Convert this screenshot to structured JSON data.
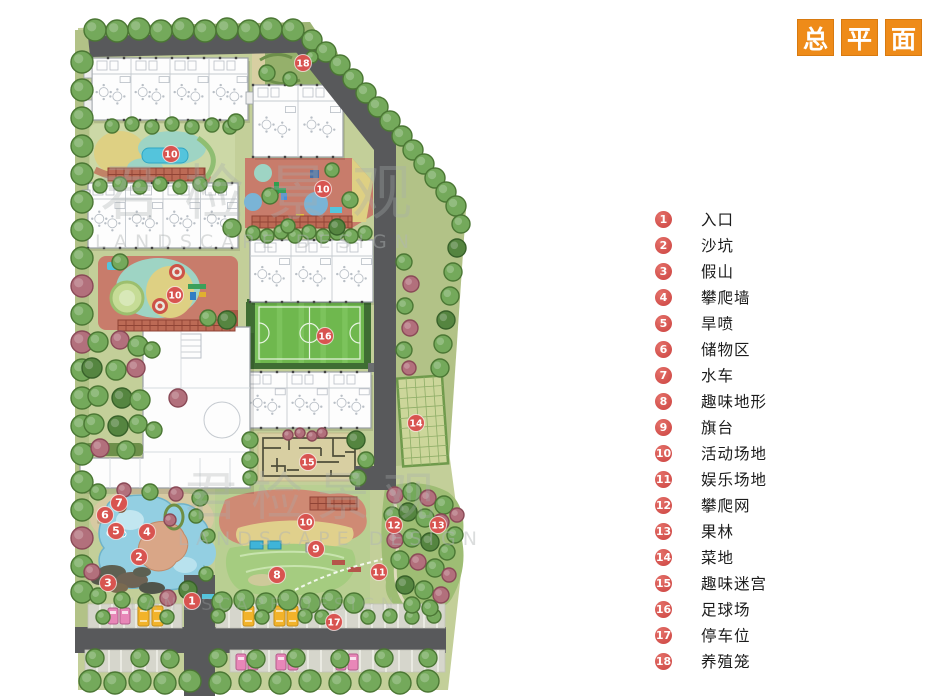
{
  "title": {
    "boxes": [
      "总",
      "平",
      "面"
    ],
    "box_color": "#ee8b19",
    "text_color": "#ffffff"
  },
  "legend": {
    "items": [
      {
        "num": "1",
        "label": "入口"
      },
      {
        "num": "2",
        "label": "沙坑"
      },
      {
        "num": "3",
        "label": "假山"
      },
      {
        "num": "4",
        "label": "攀爬墙"
      },
      {
        "num": "5",
        "label": "旱喷"
      },
      {
        "num": "6",
        "label": "储物区"
      },
      {
        "num": "7",
        "label": "水车"
      },
      {
        "num": "8",
        "label": "趣味地形"
      },
      {
        "num": "9",
        "label": "旗台"
      },
      {
        "num": "10",
        "label": "活动场地"
      },
      {
        "num": "11",
        "label": "娱乐场地"
      },
      {
        "num": "12",
        "label": "攀爬网"
      },
      {
        "num": "13",
        "label": "果林"
      },
      {
        "num": "14",
        "label": "菜地"
      },
      {
        "num": "15",
        "label": "趣味迷宫"
      },
      {
        "num": "16",
        "label": "足球场"
      },
      {
        "num": "17",
        "label": "停车位"
      },
      {
        "num": "18",
        "label": "养殖笼"
      }
    ],
    "marker_color": "#d85450"
  },
  "map": {
    "marker_color": "#d85450",
    "markers": [
      {
        "n": "1",
        "x": 192,
        "y": 601
      },
      {
        "n": "2",
        "x": 139,
        "y": 557
      },
      {
        "n": "3",
        "x": 108,
        "y": 583
      },
      {
        "n": "4",
        "x": 147,
        "y": 532
      },
      {
        "n": "5",
        "x": 116,
        "y": 531
      },
      {
        "n": "6",
        "x": 105,
        "y": 515
      },
      {
        "n": "7",
        "x": 119,
        "y": 503
      },
      {
        "n": "8",
        "x": 277,
        "y": 575
      },
      {
        "n": "9",
        "x": 316,
        "y": 549
      },
      {
        "n": "10",
        "x": 171,
        "y": 154
      },
      {
        "n": "10",
        "x": 323,
        "y": 189
      },
      {
        "n": "10",
        "x": 175,
        "y": 295
      },
      {
        "n": "10",
        "x": 306,
        "y": 522
      },
      {
        "n": "11",
        "x": 379,
        "y": 572
      },
      {
        "n": "12",
        "x": 394,
        "y": 525
      },
      {
        "n": "13",
        "x": 438,
        "y": 525
      },
      {
        "n": "14",
        "x": 416,
        "y": 423
      },
      {
        "n": "15",
        "x": 308,
        "y": 462
      },
      {
        "n": "16",
        "x": 325,
        "y": 336
      },
      {
        "n": "17",
        "x": 334,
        "y": 622
      },
      {
        "n": "18",
        "x": 303,
        "y": 63
      }
    ]
  },
  "watermark": {
    "cn": "君检景观",
    "en": "LANDSCAPE DESIGN"
  }
}
